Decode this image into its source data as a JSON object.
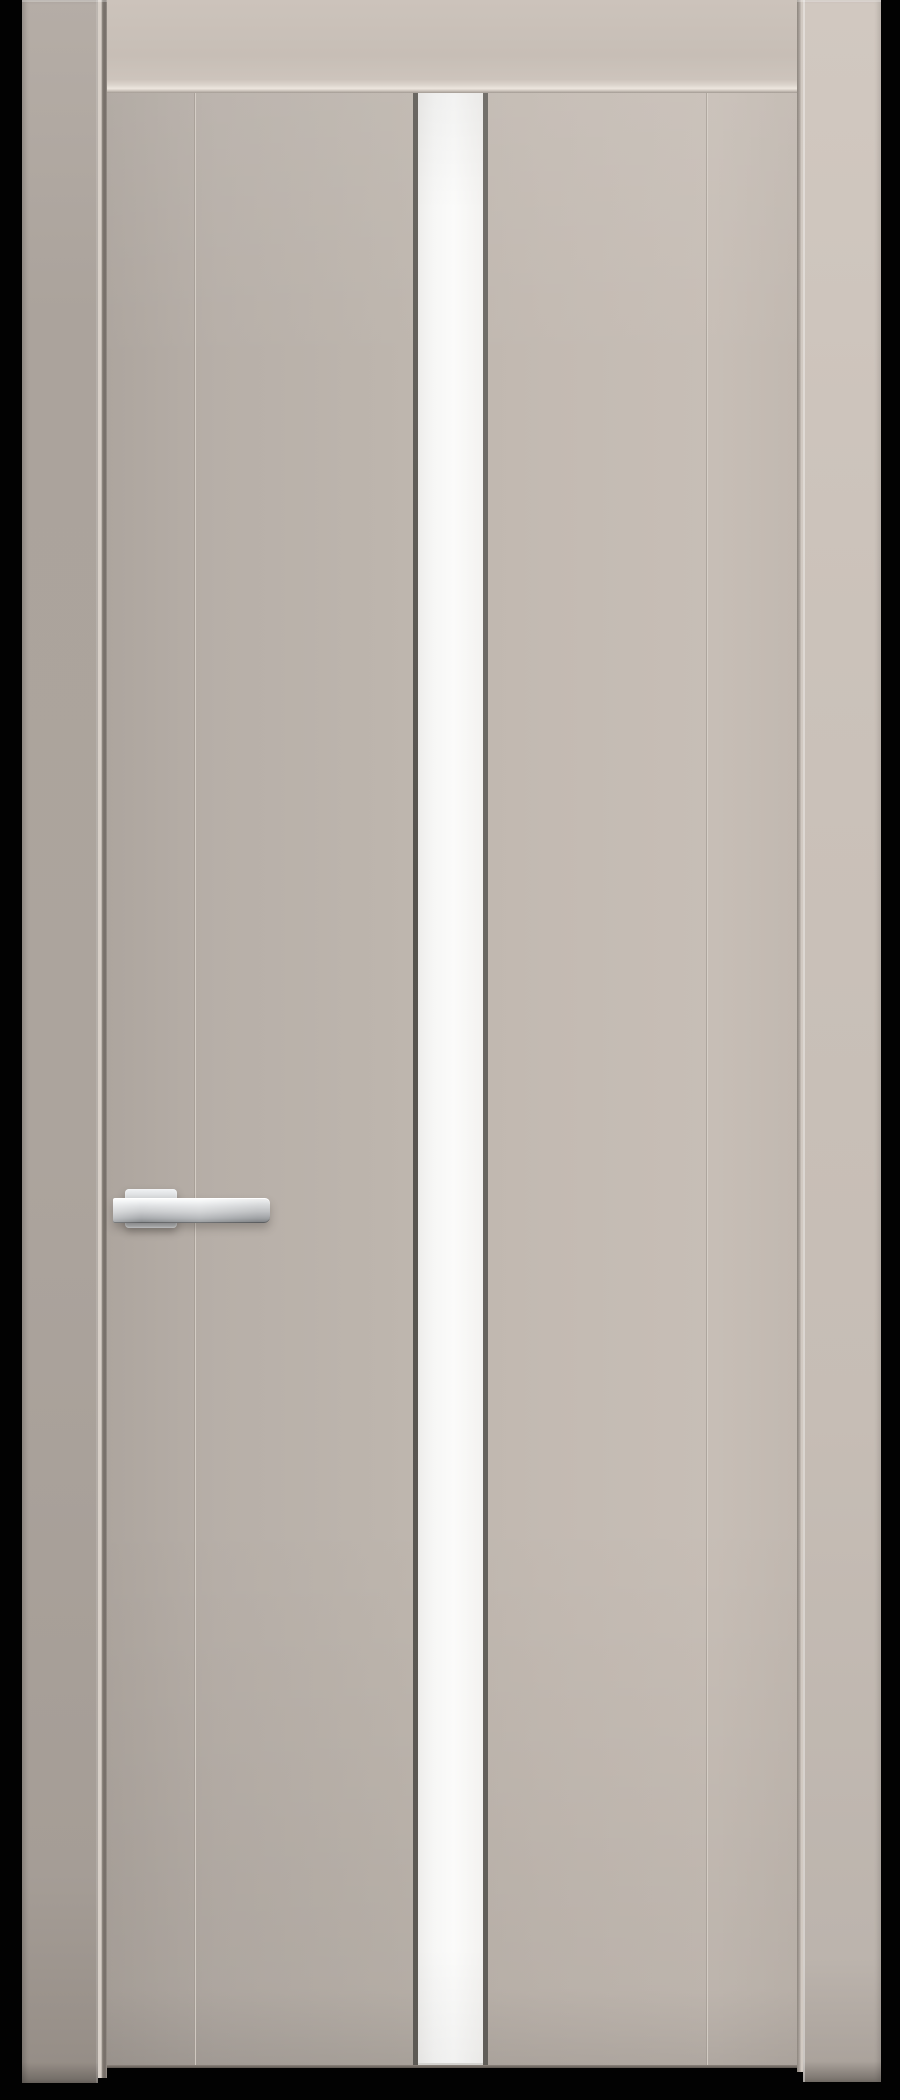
{
  "scene": {
    "alt": "Beige sand-colored interior door with frame, full-height narrow white glass stripe left of center, two vertical grooves and a chrome lever handle, photographed on a black background"
  },
  "colors": {
    "background": "#020202",
    "pillar-left": "#aca49d",
    "pillar-right": "#cbc2ba",
    "header": "#c7beb6",
    "molding-highlight": "#ede6de",
    "door-face": "#c3bab2",
    "gap-shadow": "#7f7871",
    "gap-highlight": "#d6cec6",
    "groove-dark": "rgba(118,110,102,0.55)",
    "groove-light": "rgba(238,231,223,0.9)",
    "glass-trim": "#56534e",
    "glass-pane": "#fbfbfa",
    "door-bottom-edge": "#8a827b",
    "chrome-light": "#ffffff",
    "chrome-mid": "#babcbe",
    "chrome-dark": "#8b8e91"
  }
}
